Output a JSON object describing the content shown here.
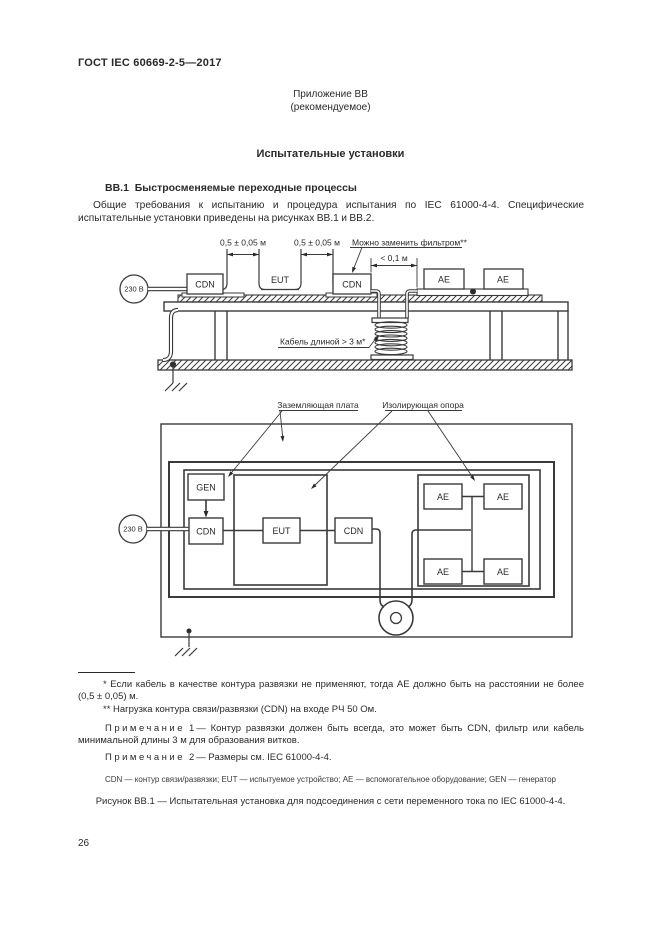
{
  "page": {
    "header": "ГОСТ IEC 60669-2-5—2017",
    "annex_label": "Приложение ВВ",
    "annex_type": "(рекомендуемое)",
    "title": "Испытательные установки",
    "section_heading": "ВВ.1  Быстросменяемые переходные процессы",
    "paragraph": "Общие требования к испытанию и процедура испытания по IEC 61000-4-4. Специфические испытательные установки приведены на рисунках ВВ.1 и ВВ.2.",
    "page_number": "26"
  },
  "figure1": {
    "source": "230 В",
    "cdn_left": "CDN",
    "eut": "EUT",
    "cdn_right": "CDN",
    "ae_left": "AE",
    "ae_right": "AE",
    "dim_left": "0,5 ± 0,05 м",
    "dim_right": "0,5 ± 0,05 м",
    "dim_ae": "< 0,1 м",
    "filter_note": "Можно заменить фильтром**",
    "cable_note": "Кабель длиной > 3 м*"
  },
  "figure2": {
    "source": "230 В",
    "gen": "GEN",
    "cdn_left": "CDN",
    "eut": "EUT",
    "cdn_right": "CDN",
    "ae_tl": "AE",
    "ae_tr": "AE",
    "ae_bl": "AE",
    "ae_br": "AE",
    "ground_plate_label": "Заземляющая плата",
    "insulating_support_label": "Изолирующая опора"
  },
  "footnotes": {
    "fn1": "* Если кабель в качестве контура развязки не применяют, тогда АЕ должно быть на расстоянии не более (0,5 ± 0,05) м.",
    "fn2": "** Нагрузка контура связи/развязки (CDN) на входе РЧ 50 Ом.",
    "note_word": "Примечание",
    "note1_num": "1",
    "note1_text": "— Контур развязки должен быть всегда, это может быть CDN, фильтр или кабель минимальной длины 3 м для образования витков.",
    "note2_num": "2",
    "note2_text": "— Размеры см. IEC 61000-4-4.",
    "legend": "CDN — контур связи/развязки; EUT — испытуемое устройство; АЕ — вспомогательное оборудование; GEN — генератор",
    "caption": "Рисунок ВВ.1 — Испытательная установка для подсоединения с сети переменного тока по IEC 61000-4-4."
  }
}
